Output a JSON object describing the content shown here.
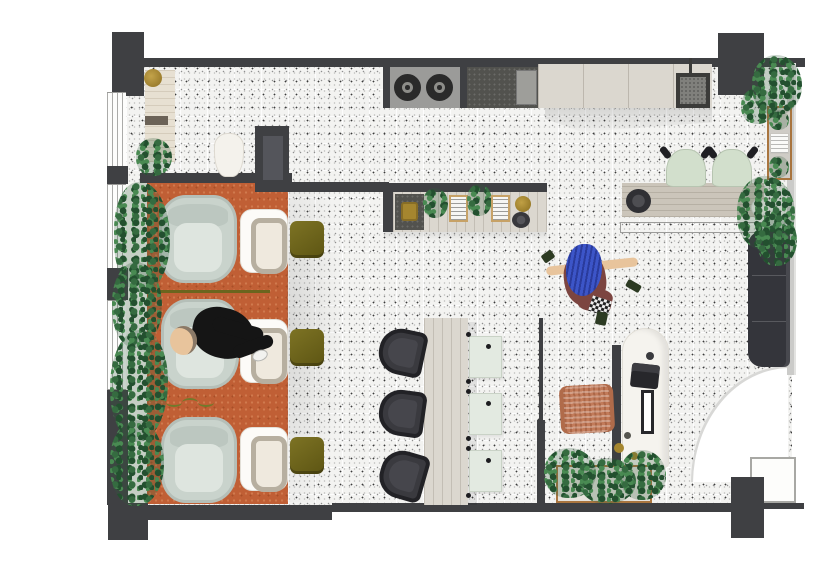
{
  "meta": {
    "title": "hair-salon-and-cafe-floor-plan",
    "view": "top-down architectural illustration, no visible text",
    "canvas": {
      "width": 820,
      "height": 562
    }
  },
  "palette": {
    "wall": "#3f4043",
    "wall_panel": "#54555b",
    "wall_light": "#cbcbc9",
    "floor": "#f3f3f1",
    "rug": "#c05f35",
    "rug_speckle": "#d07a4e",
    "wood_light": "#dbd7cf",
    "wood_mid": "#cbc5ba",
    "wood_frame": "#a9753f",
    "chair_gray": "#c9d3cc",
    "chair_gray_inner": "#dee5df",
    "basin_white": "#fcfbf8",
    "bowl_rim": "#b7afa0",
    "olive": "#6f6520",
    "green_chair": "#d2dfcc",
    "plant_dark": "#23502f",
    "plant_mid": "#356b40",
    "plant_light": "#498a52",
    "charcoal_seat": "#3a3a3f",
    "sofa": "#34353b",
    "brass": "#a5862f",
    "terracotta_chair": "#c27b5a",
    "skin": "#e8c49c",
    "denim_blue": "#3c55c8",
    "maroon": "#7c4540",
    "appliance_gray": "#9b9b99",
    "counter_dark": "#52524e",
    "panel_seat": "#e3eae1"
  },
  "rooms": [
    {
      "name": "reception",
      "features": [
        "reception-desk",
        "brass-stool",
        "white-vase",
        "plant"
      ]
    },
    {
      "name": "styling-area",
      "floor": "terracotta-rug",
      "styling_stations": 3,
      "washbasins": 3,
      "olive_stools": 3
    },
    {
      "name": "cafe-bar",
      "floor": "terrazzo",
      "bar_chairs": 3,
      "seat_panels": 3
    },
    {
      "name": "kitchen",
      "features": [
        "cooktop-2-burners",
        "dark-counter",
        "wood-counter",
        "sink-with-faucet"
      ]
    },
    {
      "name": "lounge",
      "features": [
        "dining-table",
        "green-chairs-2",
        "hatched-bench",
        "dark-sofa",
        "wall-shelf"
      ]
    },
    {
      "name": "desk-nook",
      "features": [
        "arched-desk",
        "laptop",
        "mirror",
        "rattan-chair",
        "planter-box"
      ]
    }
  ],
  "furniture_counts": {
    "salon_chairs": 3,
    "washbasins": 3,
    "olive_stools": 3,
    "bar_chairs": 3,
    "seat_panels": 3,
    "green_dining_chairs": 2,
    "cooktop_burners": 2,
    "sofas": 1,
    "doors": 1,
    "plants": 12
  },
  "people": [
    {
      "name": "client-lying",
      "location": "middle styling chair",
      "clothing": "black"
    },
    {
      "name": "stylist-walking",
      "location": "center floor",
      "clothing": "maroon with blue hair"
    }
  ]
}
